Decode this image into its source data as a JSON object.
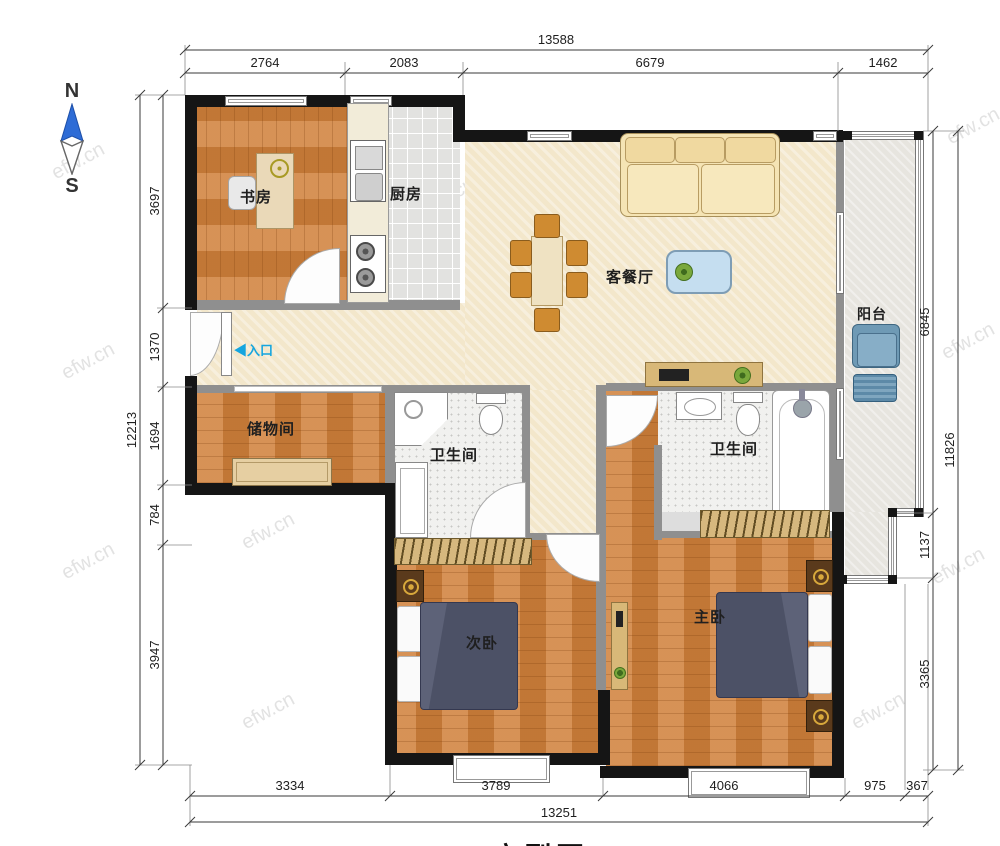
{
  "watermark": {
    "text": "efw.cn"
  },
  "compass": {
    "north": "N",
    "south": "S"
  },
  "entrance": {
    "arrow": "◀",
    "label": "入口"
  },
  "title": {
    "text": "户型图"
  },
  "rooms": {
    "study": {
      "label": "书房"
    },
    "kitchen": {
      "label": "厨房"
    },
    "living": {
      "label": "客餐厅"
    },
    "balcony": {
      "label": "阳台"
    },
    "storage": {
      "label": "储物间"
    },
    "bath_shared": {
      "label": "卫生间"
    },
    "bath_master": {
      "label": "卫生间"
    },
    "bedroom_second": {
      "label": "次卧"
    },
    "bedroom_master": {
      "label": "主卧"
    }
  },
  "dimensions": {
    "top": {
      "total": "13588",
      "segments": [
        "2764",
        "2083",
        "6679",
        "1462"
      ]
    },
    "left": {
      "total": "12213",
      "segments": [
        "3697",
        "1370",
        "1694",
        "784",
        "3947"
      ]
    },
    "right": {
      "total": "11826",
      "segments": [
        "6845",
        "1137",
        "3365"
      ]
    },
    "bottom": {
      "total": "13251",
      "segments": [
        "3334",
        "3789",
        "4066",
        "975",
        "367"
      ]
    }
  }
}
